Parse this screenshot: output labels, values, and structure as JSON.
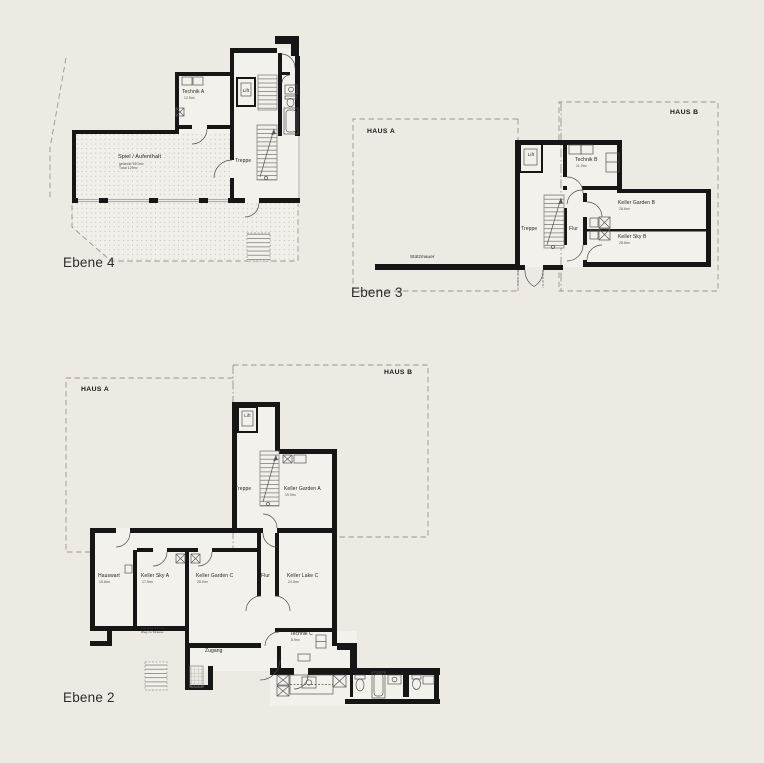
{
  "canvas": {
    "background": "#edeae4",
    "wall_color": "#161616",
    "dash_color": "#9a958c"
  },
  "plans": {
    "ebene4": {
      "caption": "Ebene 4",
      "rooms": {
        "technik": {
          "name": "Technik A",
          "area": "12.5m²"
        },
        "lift": {
          "name": "Lift"
        },
        "treppe": {
          "name": "Treppe"
        },
        "spiel": {
          "name": "Spiel / Aufenthalt",
          "sub1": "gedeckt 99.0m²",
          "sub2": "Total 129m²"
        }
      }
    },
    "ebene3": {
      "caption": "Ebene 3",
      "haus_a": "HAUS A",
      "haus_b": "HAUS B",
      "stuetzmauer": "Stützmauer",
      "rooms": {
        "lift": {
          "name": "Lift"
        },
        "treppe": {
          "name": "Treppe"
        },
        "flur": {
          "name": "Flur"
        },
        "technik": {
          "name": "Technik B",
          "area": "11.0m²"
        },
        "keller_garden": {
          "name": "Keller Garden B",
          "area": "28.6m²"
        },
        "keller_sky": {
          "name": "Keller Sky B",
          "area": "28.8m²"
        }
      }
    },
    "ebene2": {
      "caption": "Ebene 2",
      "haus_a": "HAUS A",
      "haus_b": "HAUS B",
      "note_line1": "Wanddurchbruch",
      "note_line2": "Weg zu Strasse",
      "rooms": {
        "lift": {
          "name": "Lift"
        },
        "treppe": {
          "name": "Treppe"
        },
        "keller_garden_a": {
          "name": "Keller Garden A",
          "area": "19.9m²"
        },
        "hauswart": {
          "name": "Hauswart",
          "area": "15.8m²"
        },
        "keller_sky_a": {
          "name": "Keller Sky A",
          "area": "17.5m²"
        },
        "keller_garden_c": {
          "name": "Keller Garden C",
          "area": "28.0m²"
        },
        "flur": {
          "name": "Flur"
        },
        "keller_lake_c": {
          "name": "Keller Lake C",
          "area": "24.0m²"
        },
        "technik_c": {
          "name": "Technik C",
          "area": "8.9m²"
        },
        "zugang": {
          "name": "Zugang"
        }
      }
    }
  }
}
